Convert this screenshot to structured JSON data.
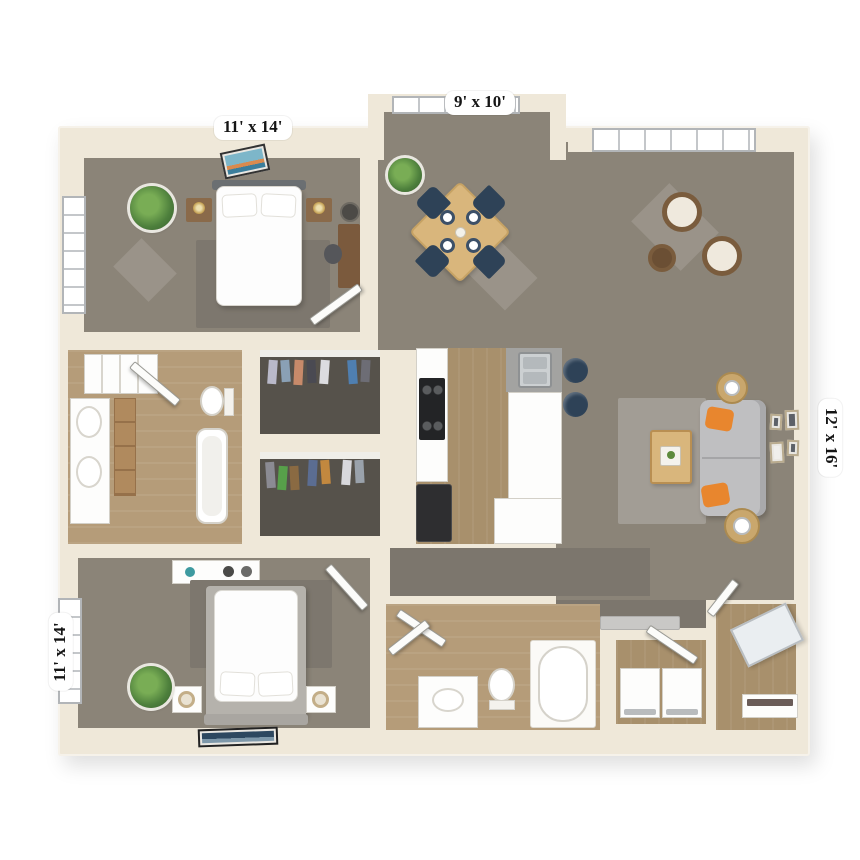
{
  "labels": {
    "bedroom_top": "11' x 14'",
    "dining_nook": "9' x 10'",
    "living_room": "12' x 16'",
    "bedroom_bottom": "11' x 14'"
  },
  "colors": {
    "wall": "#efe8d9",
    "carpet": "#8b8478",
    "carpet_dark": "#7c766d",
    "closet_floor": "#56524b",
    "wood": "#a8906c",
    "wood_light": "#b59c79",
    "sofa": "#bfbfc1",
    "pillow_accent": "#e8862e",
    "chair_navy": "#2e4257",
    "rattan": "#7a5c3d",
    "table_wood": "#d9b67c",
    "rug_gray": "#7d776e",
    "rug_light": "#a29d95"
  }
}
